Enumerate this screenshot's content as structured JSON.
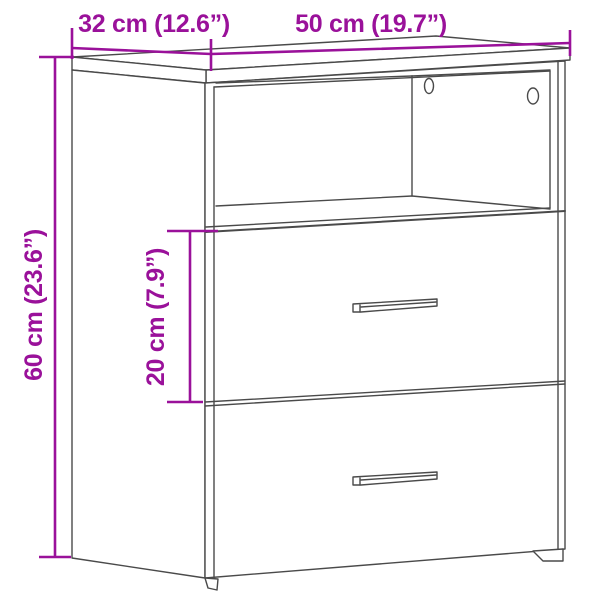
{
  "colors": {
    "accent": "#9A119A",
    "line_art": "#4a4a4a",
    "background": "#ffffff"
  },
  "diagram": {
    "type": "furniture-dimension-diagram",
    "dimensions": [
      {
        "id": "depth",
        "label": "32 cm (12.6”)",
        "value_cm": 32,
        "value_in": 12.6,
        "orientation": "horizontal-top-left"
      },
      {
        "id": "width",
        "label": "50 cm (19.7”)",
        "value_cm": 50,
        "value_in": 19.7,
        "orientation": "horizontal-top-right"
      },
      {
        "id": "height",
        "label": "60 cm (23.6”)",
        "value_cm": 60,
        "value_in": 23.6,
        "orientation": "vertical-left"
      },
      {
        "id": "drawer_height",
        "label": "20 cm (7.9”)",
        "value_cm": 20,
        "value_in": 7.9,
        "orientation": "vertical-middle"
      }
    ]
  }
}
